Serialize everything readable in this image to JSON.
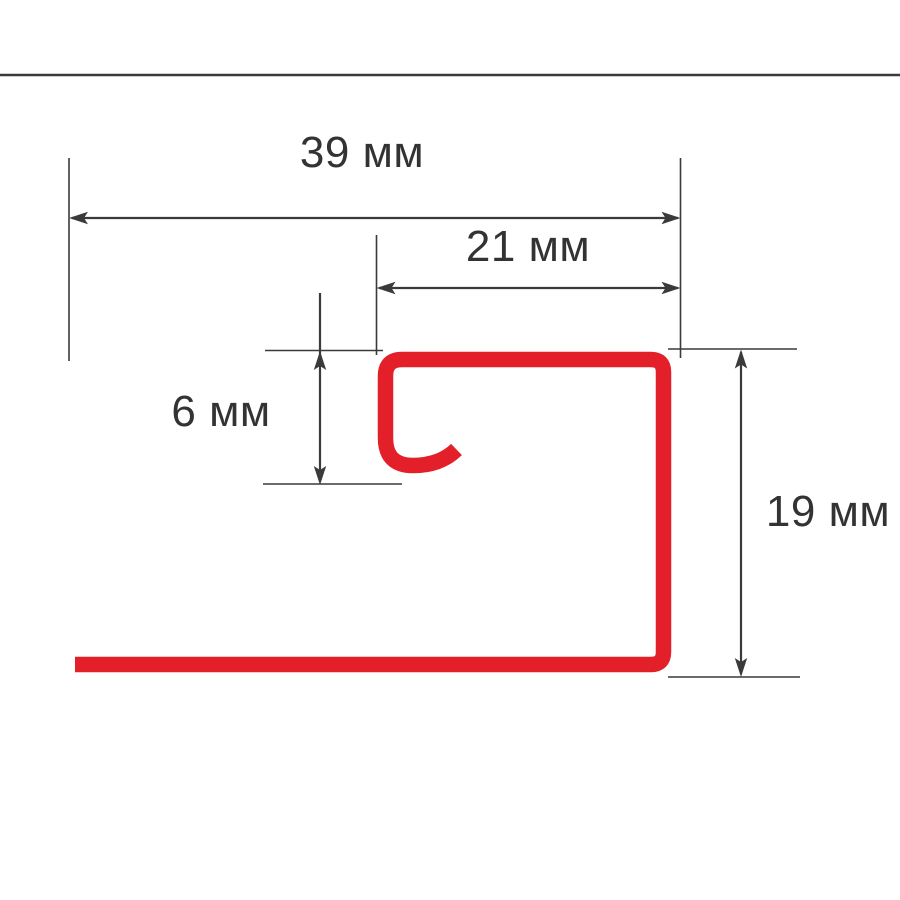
{
  "colors": {
    "profile_red": "#e3202a",
    "dimension_line": "#3a3a3a",
    "text": "#333333",
    "background": "#ffffff"
  },
  "diagram": {
    "unit": "мм",
    "dimensions": {
      "total_width": {
        "value": 39,
        "label": "39 мм"
      },
      "opening_width": {
        "value": 21,
        "label": "21 мм"
      },
      "hook_height": {
        "value": 6,
        "label": "6 мм"
      },
      "profile_height": {
        "value": 19,
        "label": "19 мм"
      }
    }
  }
}
